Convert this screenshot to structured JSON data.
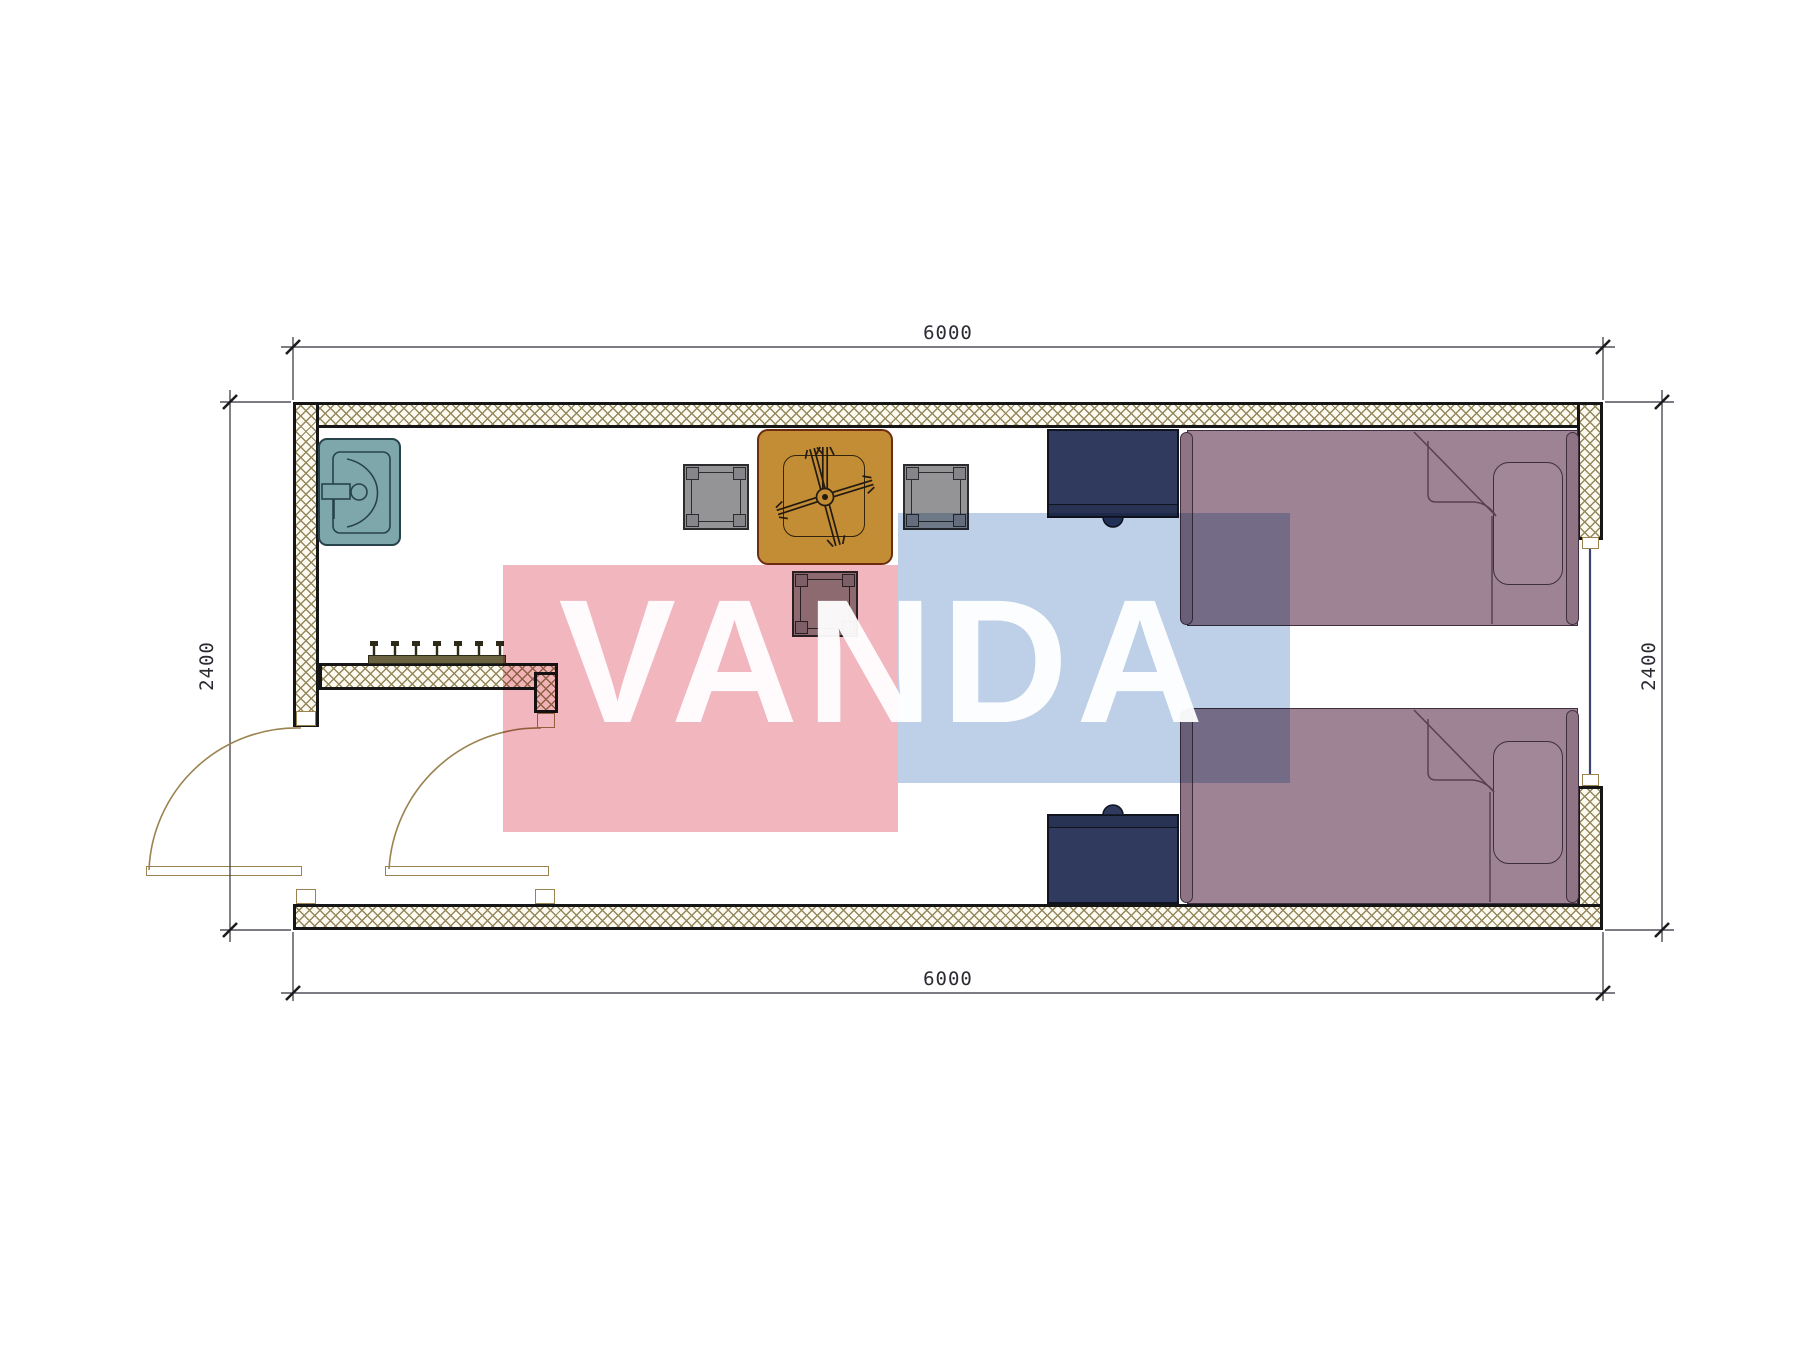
{
  "drawing": {
    "kind": "floor-plan",
    "room_items": [
      "exterior-walls",
      "entry-partition",
      "coat-hooks",
      "sink",
      "dining-table-with-fan",
      "chair-left",
      "chair-right",
      "chair-bottom",
      "nightstand-top",
      "nightstand-bottom",
      "single-bed-top",
      "single-bed-bottom",
      "pillow-top",
      "pillow-bottom",
      "entry-door-left",
      "entry-door-right",
      "window-right"
    ]
  },
  "dimensions": {
    "top": "6000",
    "bottom": "6000",
    "left": "2400",
    "right": "2400"
  },
  "watermark": {
    "text": "VANDA"
  },
  "colors": {
    "wall_hatch_line": "#94875b",
    "wall_fill": "#fdfaf2",
    "wall_outline": "#161616",
    "sink_fill": "#7ea7ac",
    "sink_line": "#27424a",
    "table_fill": "#c28d34",
    "table_border": "#6d2c12",
    "chair_fill": "#949496",
    "chair_line": "#2c2c2e",
    "nightstand_fill": "#2f3a5e",
    "nightstand_dark": "#283252",
    "bed_fill": "#9d8394",
    "bed_dark": "#8e7485",
    "pillow_fill": "#a18798",
    "bed_line": "#3f2f3e",
    "hooks_color": "#6b6340",
    "door_line": "#9b8350",
    "window_line": "#3c4272",
    "dim_line": "#2e2e3a",
    "dim_text": "#2b2b33",
    "wm_pink": "#f2b6bf",
    "wm_blue": "#bdd0e7"
  }
}
